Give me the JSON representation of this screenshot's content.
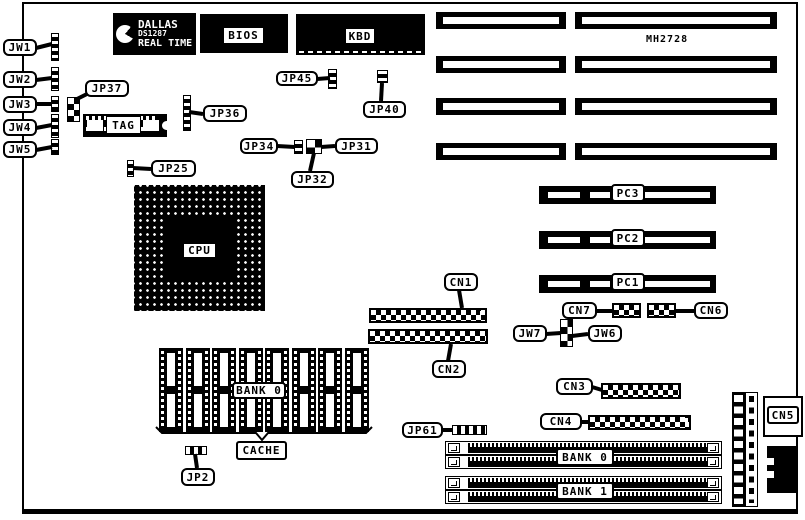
{
  "chips": {
    "dallas": {
      "l1": "DALLAS",
      "l2": "DS1287",
      "l3": "REAL TIME"
    },
    "bios": "BIOS",
    "kbd": "KBD",
    "tag": "TAG",
    "cpu": "CPU",
    "mh": "MH2728"
  },
  "callouts": {
    "jw1": "JW1",
    "jw2": "JW2",
    "jw3": "JW3",
    "jw4": "JW4",
    "jw5": "JW5",
    "jw6": "JW6",
    "jw7": "JW7",
    "jp2": "JP2",
    "jp25": "JP25",
    "jp31": "JP31",
    "jp32": "JP32",
    "jp34": "JP34",
    "jp36": "JP36",
    "jp37": "JP37",
    "jp40": "JP40",
    "jp45": "JP45",
    "jp61": "JP61",
    "cn1": "CN1",
    "cn2": "CN2",
    "cn3": "CN3",
    "cn4": "CN4",
    "cn5": "CN5",
    "cn6": "CN6",
    "cn7": "CN7",
    "cache": "CACHE"
  },
  "slots": {
    "pc1": "PC1",
    "pc2": "PC2",
    "pc3": "PC3"
  },
  "memory": {
    "cache_bank": "BANK 0",
    "simm_bank0": "BANK 0",
    "simm_bank1": "BANK 1"
  },
  "colors": {
    "ink": "#000000",
    "paper": "#ffffff"
  }
}
